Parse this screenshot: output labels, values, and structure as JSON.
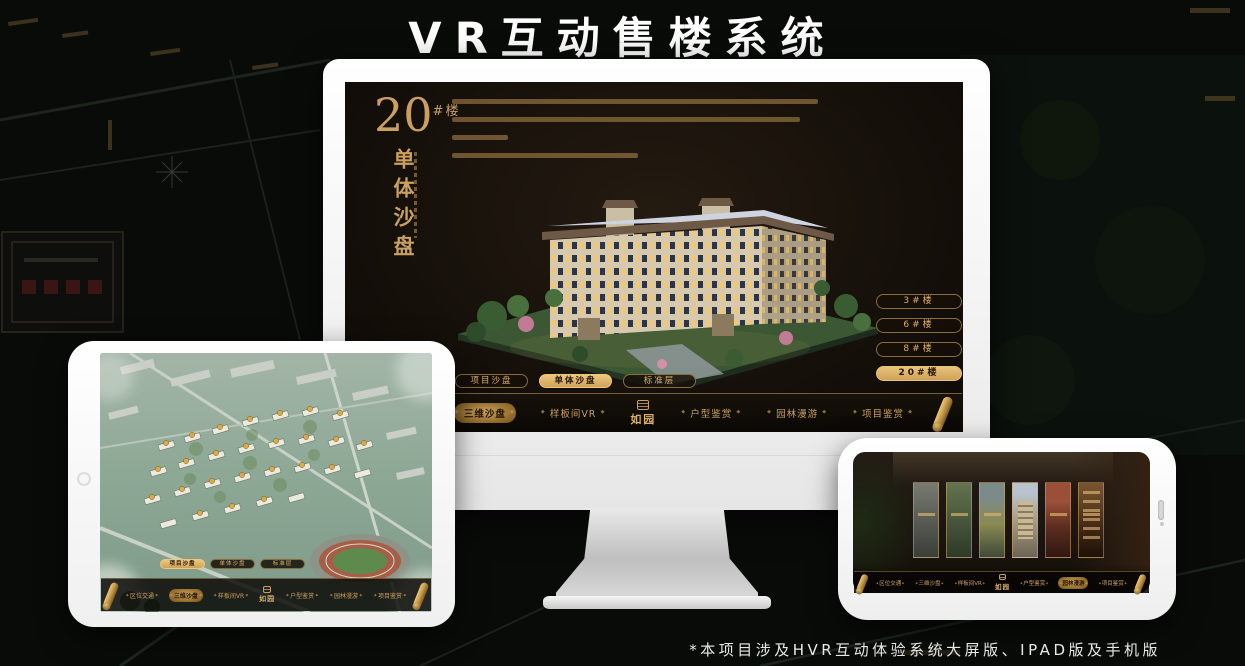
{
  "page": {
    "title": "VR互动售楼系统",
    "footnote": "*本项目涉及HVR互动体验系统大屏版、IPAD版及手机版"
  },
  "brand": {
    "logo": "如园"
  },
  "colors": {
    "gold": "#C9A05F",
    "gold_active": "#DFB56C",
    "screen_background": "#17110B",
    "title_text": "#FFFFFF"
  },
  "monitor": {
    "unit": {
      "number": "20",
      "suffix": "#楼",
      "subtitle": "单体沙盘"
    },
    "building_buttons": [
      {
        "label": "3#楼",
        "active": false
      },
      {
        "label": "6#楼",
        "active": false
      },
      {
        "label": "8#楼",
        "active": false
      },
      {
        "label": "20#楼",
        "active": true
      }
    ],
    "tabs": [
      {
        "label": "项目沙盘",
        "active": false
      },
      {
        "label": "单体沙盘",
        "active": true
      },
      {
        "label": "标准层",
        "active": false
      }
    ],
    "nav": [
      {
        "label": "区位交通",
        "active": false
      },
      {
        "label": "三维沙盘",
        "active": true
      },
      {
        "label": "样板间VR",
        "active": false
      },
      {
        "label": "户型鉴赏",
        "active": false
      },
      {
        "label": "园林漫游",
        "active": false
      },
      {
        "label": "项目鉴赏",
        "active": false
      }
    ]
  },
  "ipad": {
    "tabs": [
      {
        "label": "项目沙盘",
        "active": true
      },
      {
        "label": "单体沙盘",
        "active": false
      },
      {
        "label": "标准层",
        "active": false
      }
    ],
    "nav": [
      {
        "label": "区位交通",
        "active": false
      },
      {
        "label": "三维沙盘",
        "active": true
      },
      {
        "label": "样板间VR",
        "active": false
      },
      {
        "label": "户型鉴赏",
        "active": false
      },
      {
        "label": "园林漫游",
        "active": false
      },
      {
        "label": "项目鉴赏",
        "active": false
      }
    ]
  },
  "phone": {
    "nav": [
      {
        "label": "区位交通",
        "active": false
      },
      {
        "label": "三维沙盘",
        "active": false
      },
      {
        "label": "样板间VR",
        "active": false
      },
      {
        "label": "户型鉴赏",
        "active": false
      },
      {
        "label": "园林漫游",
        "active": true
      },
      {
        "label": "项目鉴赏",
        "active": false
      }
    ]
  }
}
